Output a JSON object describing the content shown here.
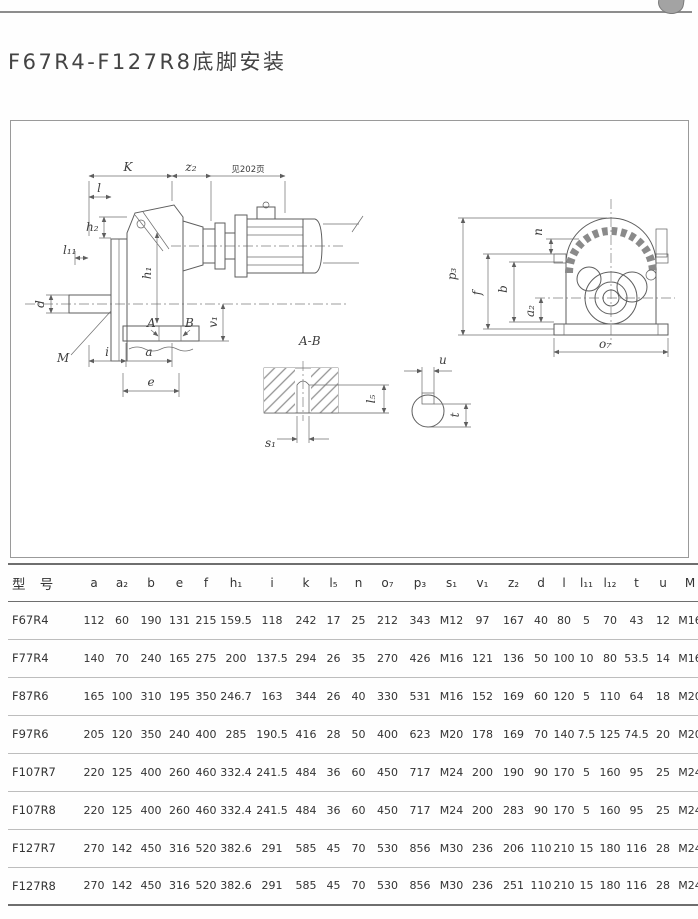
{
  "page": {
    "title": "F67R4-F127R8底脚安装"
  },
  "drawing": {
    "labels": {
      "K": "K",
      "z2": "z₂",
      "see_page": "见202页",
      "l": "l",
      "h2": "h₂",
      "l11": "l₁₁",
      "d": "d",
      "M": "M",
      "i": "i",
      "a": "a",
      "e": "e",
      "h1": "h₁",
      "A": "A",
      "B": "B",
      "v1": "v₁",
      "section": "A-B",
      "s1": "s₁",
      "l5": "l₅",
      "u": "u",
      "t": "t",
      "n": "n",
      "p3": "p₃",
      "f": "f",
      "b": "b",
      "a2": "a₂",
      "o7": "o₇"
    }
  },
  "table": {
    "headers": [
      "型 号",
      "a",
      "a₂",
      "b",
      "e",
      "f",
      "h₁",
      "i",
      "k",
      "l₅",
      "n",
      "o₇",
      "p₃",
      "s₁",
      "v₁",
      "z₂",
      "d",
      "l",
      "l₁₁",
      "l₁₂",
      "t",
      "u",
      "M"
    ],
    "rows": [
      [
        "F67R4",
        "112",
        "60",
        "190",
        "131",
        "215",
        "159.5",
        "118",
        "242",
        "17",
        "25",
        "212",
        "343",
        "M12",
        "97",
        "167",
        "40",
        "80",
        "5",
        "70",
        "43",
        "12",
        "M16"
      ],
      [
        "F77R4",
        "140",
        "70",
        "240",
        "165",
        "275",
        "200",
        "137.5",
        "294",
        "26",
        "35",
        "270",
        "426",
        "M16",
        "121",
        "136",
        "50",
        "100",
        "10",
        "80",
        "53.5",
        "14",
        "M16"
      ],
      [
        "F87R6",
        "165",
        "100",
        "310",
        "195",
        "350",
        "246.7",
        "163",
        "344",
        "26",
        "40",
        "330",
        "531",
        "M16",
        "152",
        "169",
        "60",
        "120",
        "5",
        "110",
        "64",
        "18",
        "M20"
      ],
      [
        "F97R6",
        "205",
        "120",
        "350",
        "240",
        "400",
        "285",
        "190.5",
        "416",
        "28",
        "50",
        "400",
        "623",
        "M20",
        "178",
        "169",
        "70",
        "140",
        "7.5",
        "125",
        "74.5",
        "20",
        "M20"
      ],
      [
        "F107R7",
        "220",
        "125",
        "400",
        "260",
        "460",
        "332.4",
        "241.5",
        "484",
        "36",
        "60",
        "450",
        "717",
        "M24",
        "200",
        "190",
        "90",
        "170",
        "5",
        "160",
        "95",
        "25",
        "M24"
      ],
      [
        "F107R8",
        "220",
        "125",
        "400",
        "260",
        "460",
        "332.4",
        "241.5",
        "484",
        "36",
        "60",
        "450",
        "717",
        "M24",
        "200",
        "283",
        "90",
        "170",
        "5",
        "160",
        "95",
        "25",
        "M24"
      ],
      [
        "F127R7",
        "270",
        "142",
        "450",
        "316",
        "520",
        "382.6",
        "291",
        "585",
        "45",
        "70",
        "530",
        "856",
        "M30",
        "236",
        "206",
        "110",
        "210",
        "15",
        "180",
        "116",
        "28",
        "M24"
      ],
      [
        "F127R8",
        "270",
        "142",
        "450",
        "316",
        "520",
        "382.6",
        "291",
        "585",
        "45",
        "70",
        "530",
        "856",
        "M30",
        "236",
        "251",
        "110",
        "210",
        "15",
        "180",
        "116",
        "28",
        "M24"
      ]
    ]
  }
}
